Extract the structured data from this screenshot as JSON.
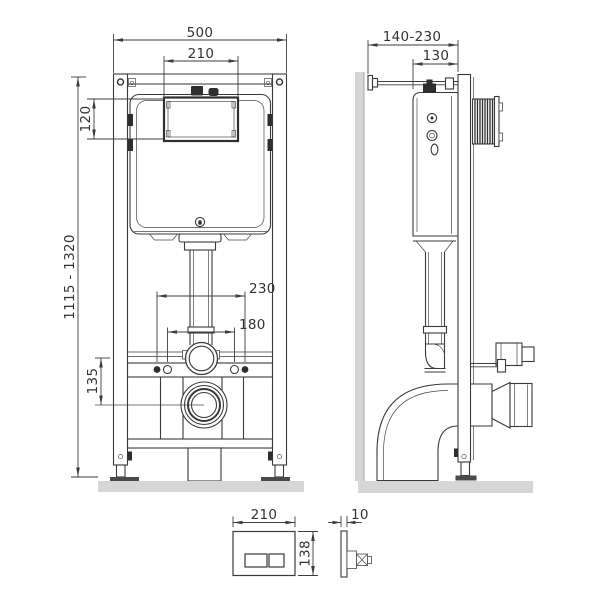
{
  "dimensions": {
    "front": {
      "overall_width": "500",
      "service_window_width": "210",
      "service_window_height": "120",
      "installation_height": "1115 - 1320",
      "drain_axis_height": "135",
      "fixing_spacing_outer": "230",
      "fixing_spacing_inner": "180"
    },
    "side": {
      "wall_distance_range": "140-230",
      "frame_depth": "130"
    },
    "flush_plate": {
      "width": "210",
      "height": "138",
      "thickness": "10"
    }
  },
  "colors": {
    "line": "#3a3a3a",
    "dimension": "#3d3d3d",
    "surface": "#d6d6d6",
    "dark_detail": "#2e2e2e",
    "background": "#ffffff"
  }
}
